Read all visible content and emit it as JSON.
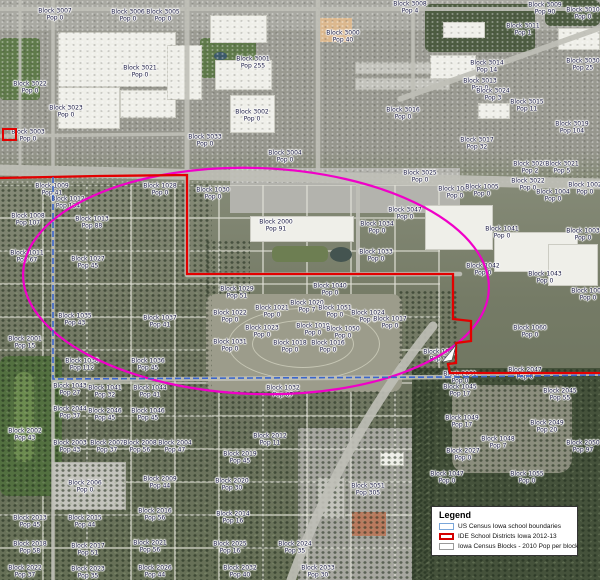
{
  "legend": {
    "title": "Legend",
    "items": [
      {
        "label": "US Census Iowa school boundaries",
        "swatch_color": "#7aa6d9"
      },
      {
        "label": "IDE School Districts Iowa 2012-13",
        "swatch_color": "#d40000"
      },
      {
        "label": "Iowa Census Blocks - 2010 Pop per block",
        "swatch_color": "#9a9a9a"
      }
    ]
  },
  "colors": {
    "district_red": "#e30000",
    "census_blue": "#3a66cc",
    "ellipse_magenta": "#f000c8"
  },
  "map": {
    "blocks": [
      {
        "x": 55,
        "y": 15,
        "t": "Block 3007",
        "p": "Pop 0"
      },
      {
        "x": 128,
        "y": 16,
        "t": "Block 3006",
        "p": "Pop 0"
      },
      {
        "x": 163,
        "y": 16,
        "t": "Block 3005",
        "p": "Pop 0"
      },
      {
        "x": 140,
        "y": 72,
        "t": "Block 3021",
        "p": "Pop 0"
      },
      {
        "x": 30,
        "y": 88,
        "t": "Block 3022",
        "p": "Pop 0"
      },
      {
        "x": 66,
        "y": 112,
        "t": "Block 3023",
        "p": "Pop 0"
      },
      {
        "x": 28,
        "y": 136,
        "t": "Block 3003",
        "p": "Pop 0"
      },
      {
        "x": 343,
        "y": 37,
        "t": "Block 3000",
        "p": "Pop 40"
      },
      {
        "x": 253,
        "y": 63,
        "t": "Block 3001",
        "p": "Pop 255"
      },
      {
        "x": 252,
        "y": 116,
        "t": "Block 3002",
        "p": "Pop 0"
      },
      {
        "x": 205,
        "y": 141,
        "t": "Block 3033",
        "p": "Pop 0"
      },
      {
        "x": 285,
        "y": 157,
        "t": "Block 3004",
        "p": "Pop 0"
      },
      {
        "x": 410,
        "y": 8,
        "t": "Block 3008",
        "p": "Pop 4"
      },
      {
        "x": 545,
        "y": 9,
        "t": "Block 3009",
        "p": "Pop 90"
      },
      {
        "x": 583,
        "y": 14,
        "t": "Block 3010",
        "p": "Pop 0"
      },
      {
        "x": 523,
        "y": 30,
        "t": "Block 3011",
        "p": "Pop 1"
      },
      {
        "x": 487,
        "y": 67,
        "t": "Block 3014",
        "p": "Pop 14"
      },
      {
        "x": 583,
        "y": 65,
        "t": "Block 3030",
        "p": "Pop 25"
      },
      {
        "x": 480,
        "y": 85,
        "t": "Block 3013",
        "p": "Pop 0"
      },
      {
        "x": 493,
        "y": 95,
        "t": "Block 3024",
        "p": "Pop 3"
      },
      {
        "x": 527,
        "y": 106,
        "t": "Block 3015",
        "p": "Pop 11"
      },
      {
        "x": 403,
        "y": 114,
        "t": "Block 3016",
        "p": "Pop 0"
      },
      {
        "x": 572,
        "y": 128,
        "t": "Block 3019",
        "p": "Pop 104"
      },
      {
        "x": 477,
        "y": 144,
        "t": "Block 3017",
        "p": "Pop 32"
      },
      {
        "x": 420,
        "y": 177,
        "t": "Block 3025",
        "p": "Pop 0"
      },
      {
        "x": 530,
        "y": 168,
        "t": "Block 3020",
        "p": "Pop 2"
      },
      {
        "x": 562,
        "y": 168,
        "t": "Block 3021",
        "p": "Pop 5"
      },
      {
        "x": 528,
        "y": 185,
        "t": "Block 3022",
        "p": "Pop 0"
      },
      {
        "x": 585,
        "y": 189,
        "t": "Block 1002",
        "p": "Pop 0"
      },
      {
        "x": 455,
        "y": 193,
        "t": "Block 1006",
        "p": "Pop 0"
      },
      {
        "x": 482,
        "y": 191,
        "t": "Block 1005",
        "p": "Pop 0"
      },
      {
        "x": 553,
        "y": 196,
        "t": "Block 1004",
        "p": "Pop 0"
      },
      {
        "x": 405,
        "y": 214,
        "t": "Block 3047",
        "p": "Pop 0"
      },
      {
        "x": 502,
        "y": 233,
        "t": "Block 1041",
        "p": "Pop 0"
      },
      {
        "x": 583,
        "y": 235,
        "t": "Block 1003",
        "p": "Pop 0"
      },
      {
        "x": 483,
        "y": 270,
        "t": "Block 1042",
        "p": "Pop 0"
      },
      {
        "x": 545,
        "y": 278,
        "t": "Block 1043",
        "p": "Pop 0"
      },
      {
        "x": 588,
        "y": 295,
        "t": "Block 1007",
        "p": "Pop 0"
      },
      {
        "x": 52,
        "y": 190,
        "t": "Block 1009",
        "p": "Pop 41"
      },
      {
        "x": 68,
        "y": 203,
        "t": "Block 1012",
        "p": "Pop 134"
      },
      {
        "x": 28,
        "y": 220,
        "t": "Block 1008",
        "p": "Pop 107"
      },
      {
        "x": 92,
        "y": 223,
        "t": "Block 1013",
        "p": "Pop 88"
      },
      {
        "x": 27,
        "y": 257,
        "t": "Block 1011",
        "p": "Pop 67"
      },
      {
        "x": 88,
        "y": 263,
        "t": "Block 1027",
        "p": "Pop 45"
      },
      {
        "x": 160,
        "y": 190,
        "t": "Block 1028",
        "p": "Pop 0"
      },
      {
        "x": 213,
        "y": 194,
        "t": "Block 1030",
        "p": "Pop 0"
      },
      {
        "x": 276,
        "y": 226,
        "t": "Block 2000",
        "p": "Pop 91"
      },
      {
        "x": 377,
        "y": 228,
        "t": "Block 1034",
        "p": "Pop 0"
      },
      {
        "x": 376,
        "y": 256,
        "t": "Block 1033",
        "p": "Pop 0"
      },
      {
        "x": 330,
        "y": 290,
        "t": "Block 1040",
        "p": "Pop 0"
      },
      {
        "x": 237,
        "y": 293,
        "t": "Block 1029",
        "p": "Pop 51"
      },
      {
        "x": 230,
        "y": 317,
        "t": "Block 1022",
        "p": "Pop 0"
      },
      {
        "x": 272,
        "y": 312,
        "t": "Block 1021",
        "p": "Pop 0"
      },
      {
        "x": 307,
        "y": 307,
        "t": "Block 1020",
        "p": "Pop 7"
      },
      {
        "x": 335,
        "y": 312,
        "t": "Block 1051",
        "p": "Pop 0"
      },
      {
        "x": 262,
        "y": 332,
        "t": "Block 1023",
        "p": "Pop 0"
      },
      {
        "x": 313,
        "y": 330,
        "t": "Block 1019",
        "p": "Pop 0"
      },
      {
        "x": 343,
        "y": 333,
        "t": "Block 1050",
        "p": "Pop 0"
      },
      {
        "x": 230,
        "y": 346,
        "t": "Block 1031",
        "p": "Pop 0"
      },
      {
        "x": 290,
        "y": 347,
        "t": "Block 1018",
        "p": "Pop 0"
      },
      {
        "x": 328,
        "y": 347,
        "t": "Block 1016",
        "p": "Pop 0"
      },
      {
        "x": 368,
        "y": 317,
        "t": "Block 1024",
        "p": "Pop 0"
      },
      {
        "x": 390,
        "y": 323,
        "t": "Block 1017",
        "p": "Pop 0"
      },
      {
        "x": 283,
        "y": 392,
        "t": "Block 1032",
        "p": "Pop 67"
      },
      {
        "x": 75,
        "y": 320,
        "t": "Block 1035",
        "p": "Pop 43"
      },
      {
        "x": 160,
        "y": 322,
        "t": "Block 1037",
        "p": "Pop 41"
      },
      {
        "x": 25,
        "y": 343,
        "t": "Block 2001",
        "p": "Pop 15"
      },
      {
        "x": 82,
        "y": 365,
        "t": "Block 1038",
        "p": "Pop 112"
      },
      {
        "x": 148,
        "y": 365,
        "t": "Block 1036",
        "p": "Pop 45"
      },
      {
        "x": 70,
        "y": 390,
        "t": "Block 1043",
        "p": "Pop 27"
      },
      {
        "x": 105,
        "y": 392,
        "t": "Block 1041",
        "p": "Pop 32"
      },
      {
        "x": 150,
        "y": 392,
        "t": "Block 1044",
        "p": "Pop 41"
      },
      {
        "x": 70,
        "y": 413,
        "t": "Block 2044",
        "p": "Pop 37"
      },
      {
        "x": 105,
        "y": 415,
        "t": "Block 2046",
        "p": "Pop 45"
      },
      {
        "x": 148,
        "y": 415,
        "t": "Block 1046",
        "p": "Pop 45"
      },
      {
        "x": 25,
        "y": 435,
        "t": "Block 2002",
        "p": "Pop 43"
      },
      {
        "x": 70,
        "y": 447,
        "t": "Block 2003",
        "p": "Pop 43"
      },
      {
        "x": 107,
        "y": 447,
        "t": "Block 2007",
        "p": "Pop 37"
      },
      {
        "x": 140,
        "y": 447,
        "t": "Block 2008",
        "p": "Pop 56"
      },
      {
        "x": 175,
        "y": 447,
        "t": "Block 2004",
        "p": "Pop 47"
      },
      {
        "x": 160,
        "y": 483,
        "t": "Block 2009",
        "p": "Pop 44"
      },
      {
        "x": 85,
        "y": 487,
        "t": "Block 2006",
        "p": "Pop 0"
      },
      {
        "x": 30,
        "y": 522,
        "t": "Block 2013",
        "p": "Pop 45"
      },
      {
        "x": 85,
        "y": 522,
        "t": "Block 2015",
        "p": "Pop 44"
      },
      {
        "x": 155,
        "y": 515,
        "t": "Block 2016",
        "p": "Pop 56"
      },
      {
        "x": 30,
        "y": 548,
        "t": "Block 2018",
        "p": "Pop 58"
      },
      {
        "x": 88,
        "y": 550,
        "t": "Block 2017",
        "p": "Pop 51"
      },
      {
        "x": 150,
        "y": 547,
        "t": "Block 2021",
        "p": "Pop 56"
      },
      {
        "x": 25,
        "y": 572,
        "t": "Block 2022",
        "p": "Pop 37"
      },
      {
        "x": 88,
        "y": 573,
        "t": "Block 2023",
        "p": "Pop 35"
      },
      {
        "x": 155,
        "y": 572,
        "t": "Block 2026",
        "p": "Pop 44"
      },
      {
        "x": 270,
        "y": 440,
        "t": "Block 2012",
        "p": "Pop 11"
      },
      {
        "x": 240,
        "y": 458,
        "t": "Block 2019",
        "p": "Pop 45"
      },
      {
        "x": 232,
        "y": 485,
        "t": "Block 2020",
        "p": "Pop 30"
      },
      {
        "x": 233,
        "y": 518,
        "t": "Block 2014",
        "p": "Pop 16"
      },
      {
        "x": 230,
        "y": 548,
        "t": "Block 2025",
        "p": "Pop 16"
      },
      {
        "x": 295,
        "y": 548,
        "t": "Block 2024",
        "p": "Pop 35"
      },
      {
        "x": 240,
        "y": 572,
        "t": "Block 2032",
        "p": "Pop 40"
      },
      {
        "x": 318,
        "y": 572,
        "t": "Block 2033",
        "p": "Pop 30"
      },
      {
        "x": 368,
        "y": 490,
        "t": "Block 3051",
        "p": "Pop 305"
      },
      {
        "x": 530,
        "y": 332,
        "t": "Block 1060",
        "p": "Pop 0"
      },
      {
        "x": 440,
        "y": 356,
        "t": "Block 1061",
        "p": "Pop 35"
      },
      {
        "x": 460,
        "y": 378,
        "t": "Block 2031",
        "p": "Pop 0"
      },
      {
        "x": 460,
        "y": 391,
        "t": "Block 1045",
        "p": "Pop 17"
      },
      {
        "x": 525,
        "y": 374,
        "t": "Block 2047",
        "p": "Pop 0"
      },
      {
        "x": 560,
        "y": 395,
        "t": "Block 2045",
        "p": "Pop 55"
      },
      {
        "x": 462,
        "y": 422,
        "t": "Block 1049",
        "p": "Pop 17"
      },
      {
        "x": 547,
        "y": 427,
        "t": "Block 2049",
        "p": "Pop 20"
      },
      {
        "x": 583,
        "y": 447,
        "t": "Block 2050",
        "p": "Pop 97"
      },
      {
        "x": 498,
        "y": 443,
        "t": "Block 1048",
        "p": "Pop 7"
      },
      {
        "x": 463,
        "y": 455,
        "t": "Block 2027",
        "p": "Pop 0"
      },
      {
        "x": 447,
        "y": 478,
        "t": "Block 1047",
        "p": "Pop 0"
      },
      {
        "x": 527,
        "y": 478,
        "t": "Block 1055",
        "p": "Pop 0"
      }
    ]
  }
}
